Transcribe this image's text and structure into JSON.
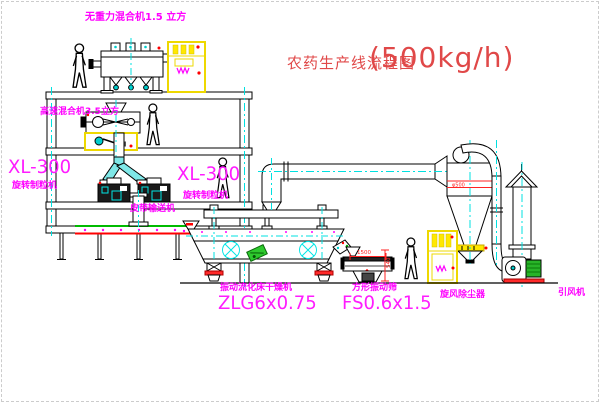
{
  "title": {
    "name": "农药生产线流程图",
    "capacity": "(500kg/h)"
  },
  "labels": {
    "gravity_mixer": "无重力混合机1.5 立方",
    "high_speed_mixer": "高速混合机3.5立方",
    "granulator_left_model": "XL-300",
    "granulator_left_name": "旋转制粒机",
    "granulator_right_model": "XL-300",
    "granulator_right_name": "旋转制粒机",
    "belt_conveyor": "皮带输送机",
    "dryer_name": "振动流化床干燥机",
    "dryer_model": "ZLG6x0.75",
    "screen_name": "方形振动筛",
    "screen_model": "FS0.6x1.5",
    "cyclone_name": "旋风除尘器",
    "fan_name": "引风机"
  },
  "dimensions": {
    "screen_length": "1500",
    "screen_height": "540",
    "cyclone_diameter": "φ500"
  },
  "colors": {
    "label_magenta": "#ff00ff",
    "title_red": "#e04848",
    "dimension_red": "#ff2222",
    "centerline_cyan": "#00e0e0",
    "cabinet_yellow": "#eed800",
    "motor_green": "#28b428",
    "conveyor_green": "#00bb00",
    "accent_red": "#ff0000"
  }
}
